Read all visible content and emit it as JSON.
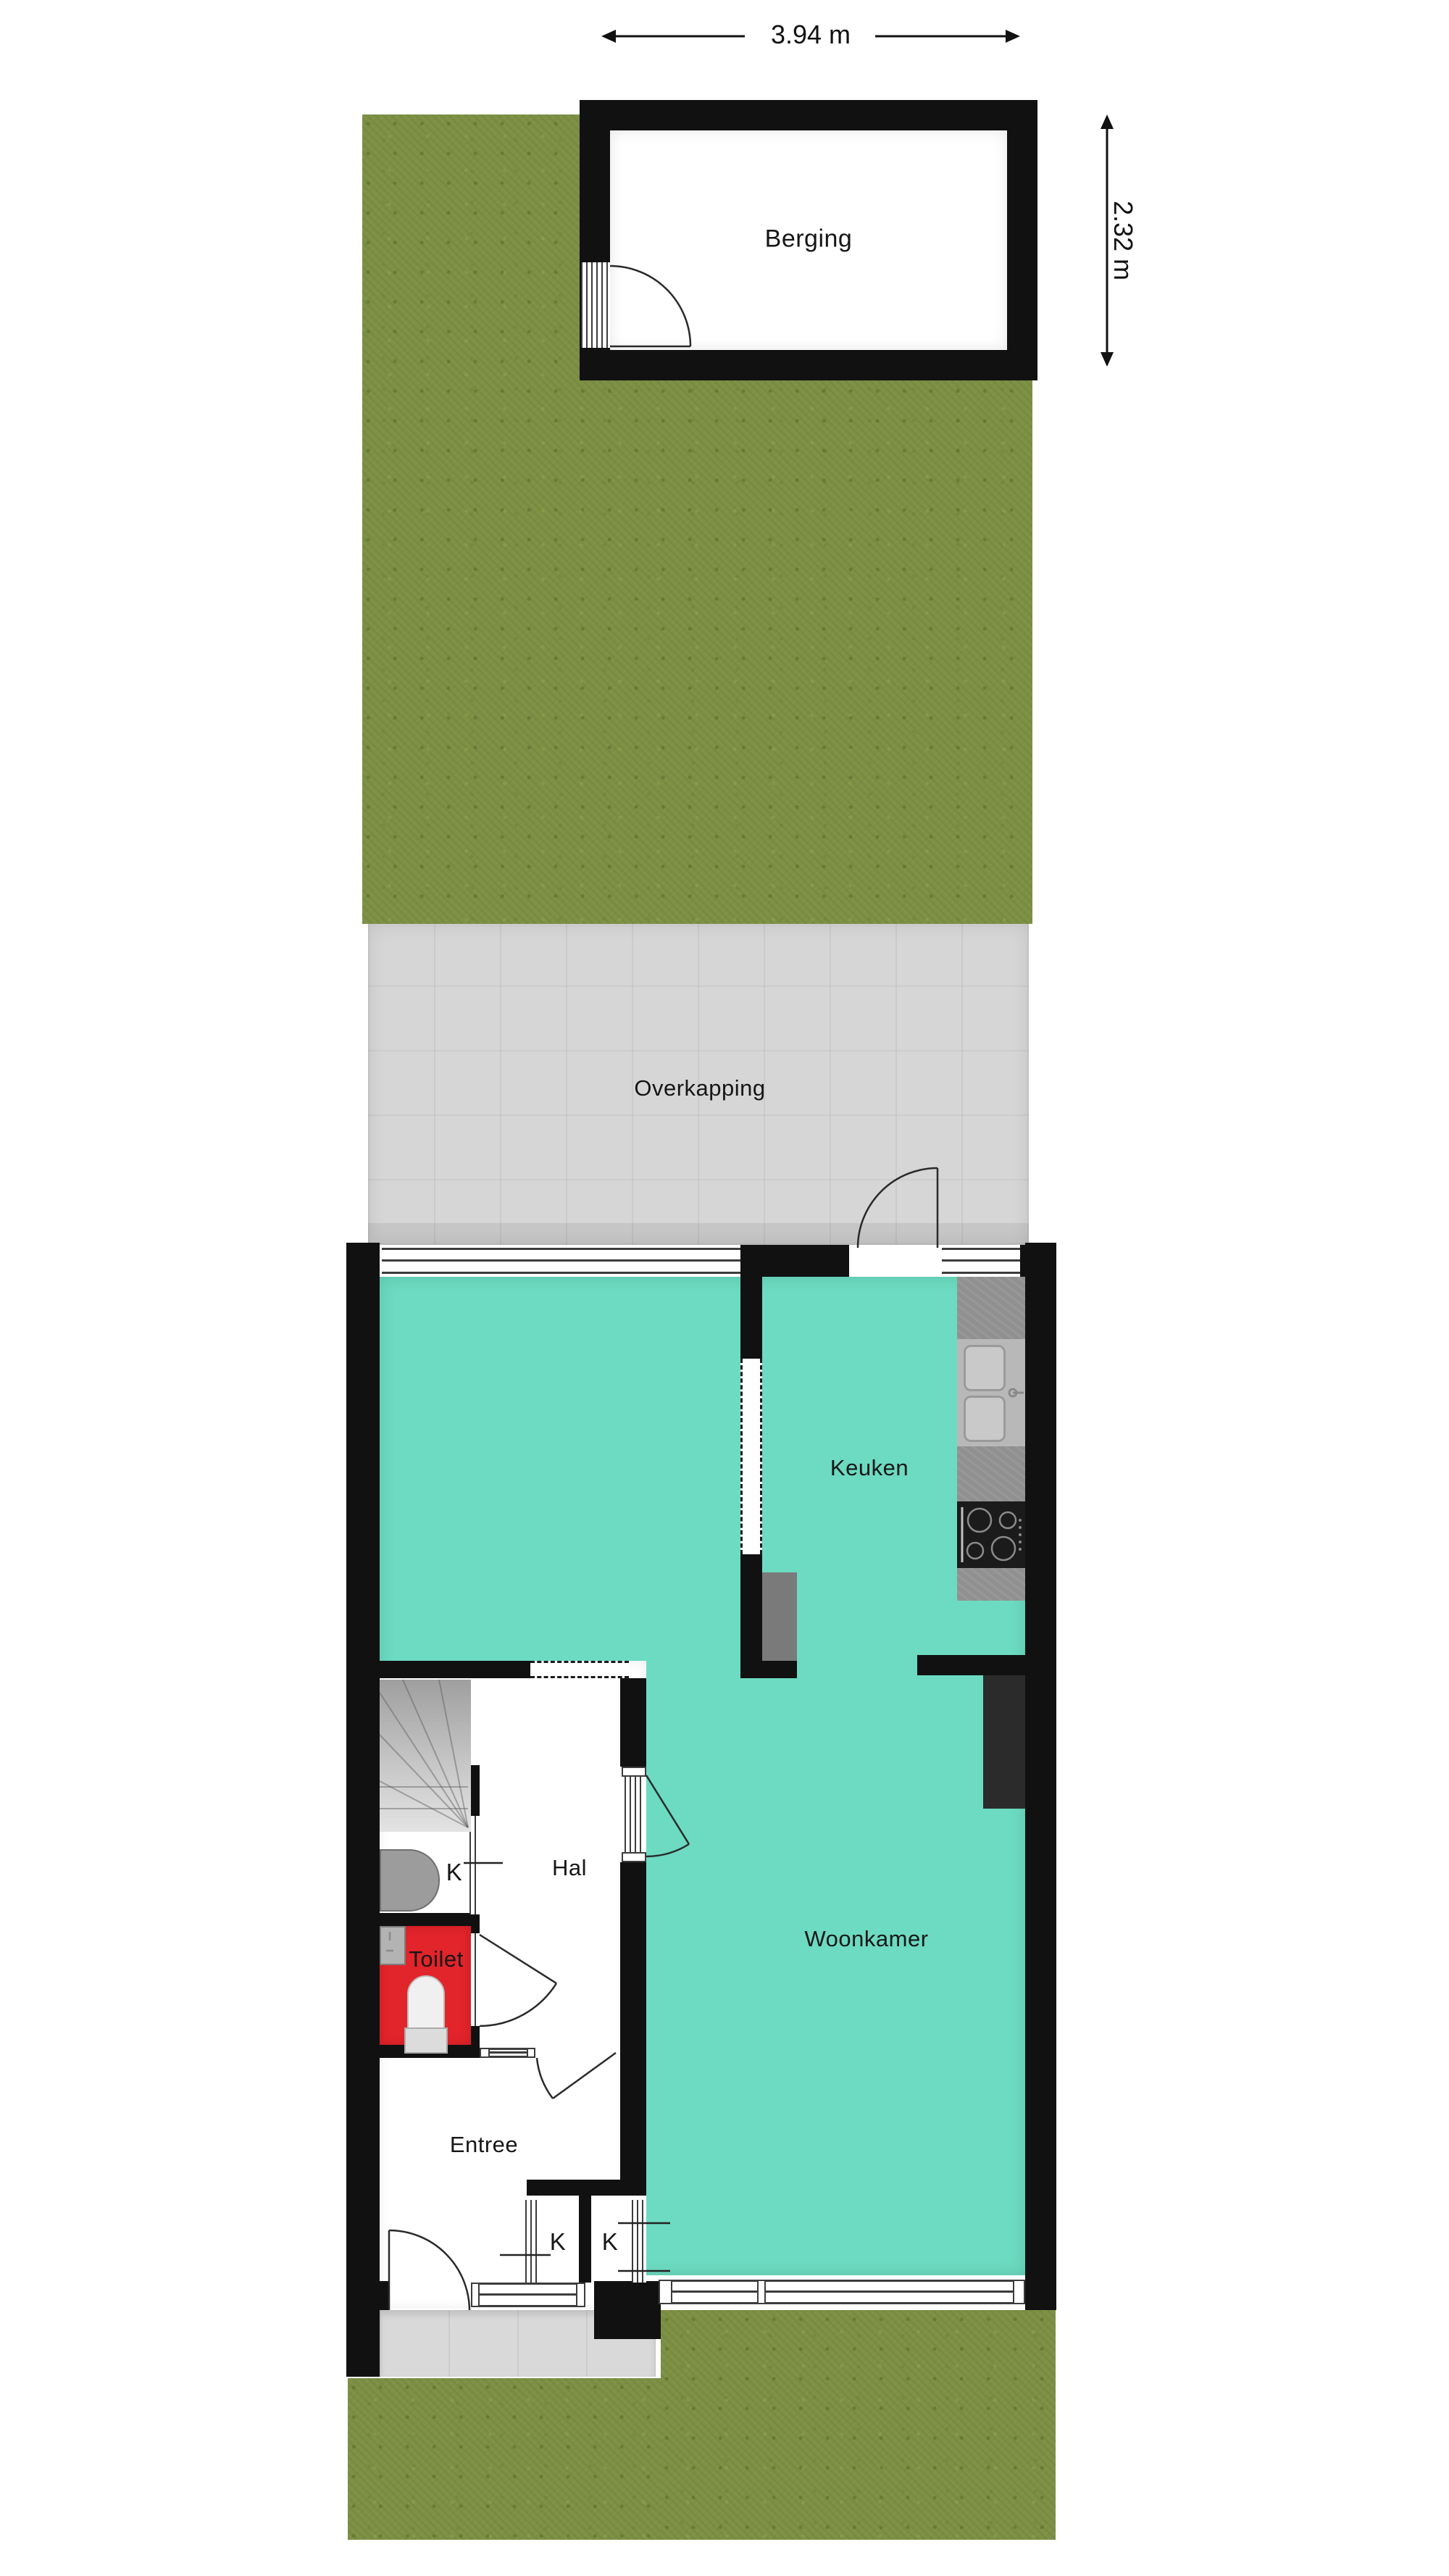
{
  "dimensions": {
    "width": {
      "label": "3.94 m"
    },
    "depth": {
      "label": "2.32 m"
    }
  },
  "rooms": {
    "berging": {
      "label": "Berging"
    },
    "overkapping": {
      "label": "Overkapping"
    },
    "keuken": {
      "label": "Keuken"
    },
    "woonkamer": {
      "label": "Woonkamer"
    },
    "hal": {
      "label": "Hal"
    },
    "toilet": {
      "label": "Toilet"
    },
    "entree": {
      "label": "Entree"
    },
    "kast_understairs": {
      "label": "K"
    },
    "kast_entree": {
      "label": "K"
    },
    "kast_woonkamer": {
      "label": "K"
    }
  },
  "colors": {
    "teal": "#6cdbc1",
    "toilet_red": "#e2242b",
    "wall": "#111111",
    "grass": "#7d9045",
    "paving": "#d6d6d6",
    "stoop": "#d9d9d9",
    "counter": "#909090",
    "stove": "#1b1b1b"
  }
}
